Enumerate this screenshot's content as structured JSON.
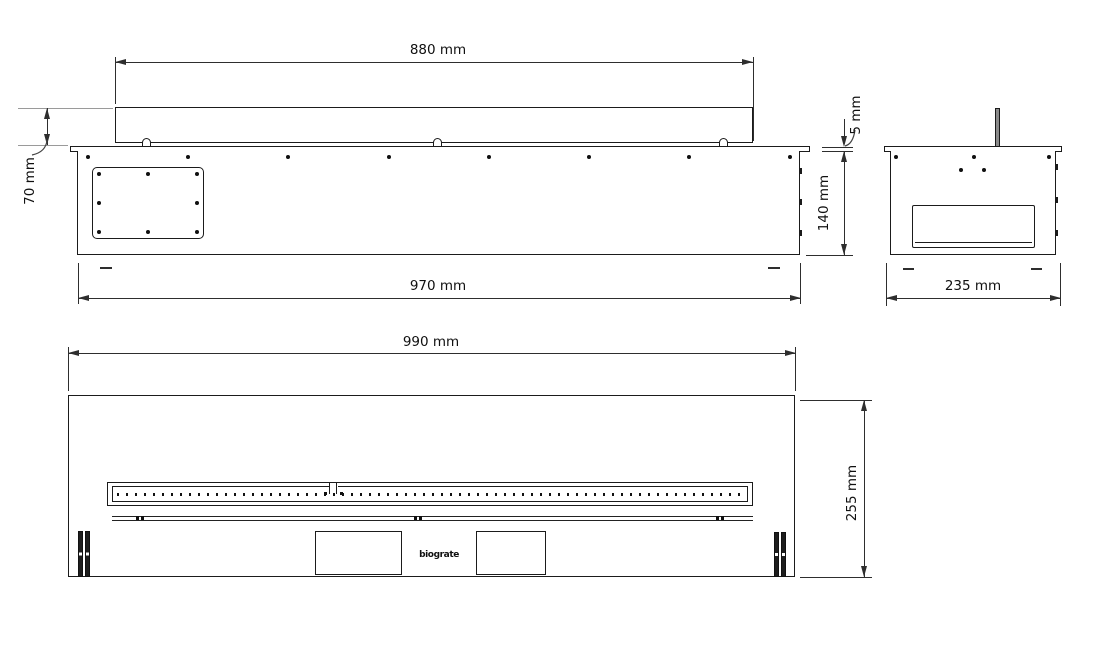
{
  "colors": {
    "background": "#ffffff",
    "object_line": "#1b1b1b",
    "dimension_line": "#2e2e2e",
    "extension_gray": "#9a9a9a",
    "text": "#101010"
  },
  "views": {
    "front": {
      "dims": {
        "burner_width": "880 mm",
        "burner_height_above_plate": "70 mm",
        "body_width": "970 mm",
        "plate_thickness": "5 mm",
        "body_height": "140 mm"
      }
    },
    "side": {
      "dims": {
        "depth": "235 mm"
      }
    },
    "top": {
      "dims": {
        "overall_width": "990 mm",
        "overall_depth": "255 mm"
      },
      "logo": "biograte"
    }
  }
}
